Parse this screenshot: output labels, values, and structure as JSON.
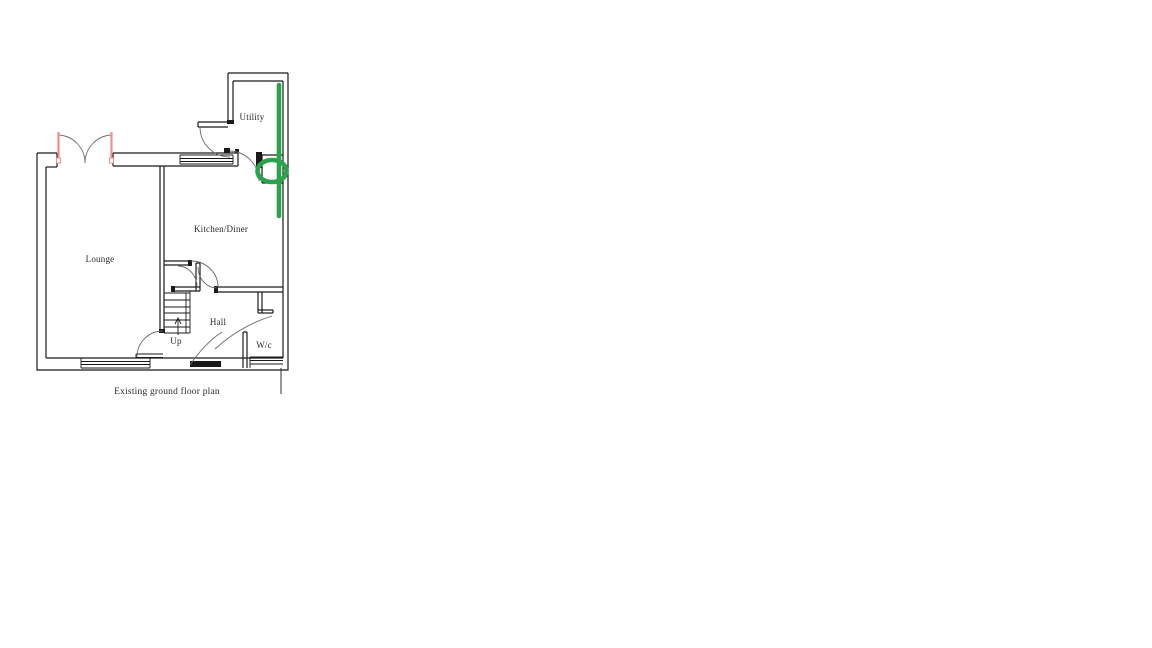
{
  "page": {
    "background": "#ffffff",
    "type": "floor-plan-drawing"
  },
  "colors": {
    "wall_line": "#1a1a1a",
    "arc_line": "#6a6a6a",
    "door_highlight_red": "#f28b8b",
    "annotation_green": "#2aa34c",
    "text": "#2a2a2a"
  },
  "floor_plan": {
    "caption": "Existing ground floor plan",
    "rooms": {
      "utility": "Utility",
      "kitchen_diner": "Kitchen/Diner",
      "lounge": "Lounge",
      "hall": "Hall",
      "wc": "W/c"
    },
    "stairs": {
      "direction_label": "Up"
    },
    "annotations": {
      "green_marker": {
        "description": "green vertical line along right wall with ellipse circling rear doorway",
        "color": "#2aa34c"
      },
      "red_marker": {
        "description": "french door leaves highlighted red at top of lounge",
        "color": "#f28b8b"
      }
    }
  }
}
